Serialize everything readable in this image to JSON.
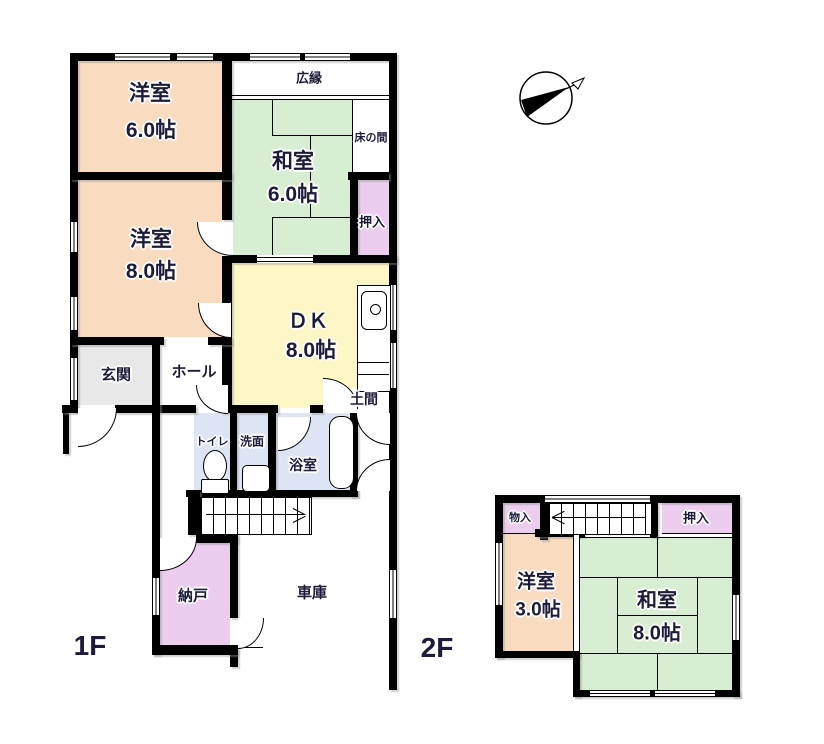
{
  "colors": {
    "wall": "#000000",
    "text": "#1c1c3a",
    "western_room": "#f9dcc0",
    "japanese_room": "#d7eed2",
    "dk_room": "#fdf7c5",
    "closet": "#eccdef",
    "wet_room": "#dde4f4",
    "entrance": "#e8e8e8"
  },
  "f1": {
    "label": "1F",
    "yoshitsu6": {
      "name": "洋室",
      "size": "6.0帖"
    },
    "yoshitsu8": {
      "name": "洋室",
      "size": "8.0帖"
    },
    "washitsu6": {
      "name": "和室",
      "size": "6.0帖"
    },
    "hiroen": {
      "name": "広縁"
    },
    "tokonoma": {
      "name": "床の間"
    },
    "oshiire": {
      "name": "押入"
    },
    "dk": {
      "name": "ＤＫ",
      "size": "8.0帖"
    },
    "doma": {
      "name": "土間"
    },
    "genkan": {
      "name": "玄関"
    },
    "hall": {
      "name": "ホール"
    },
    "toilet": {
      "name": "トイレ"
    },
    "senmen": {
      "name": "洗面"
    },
    "yokushitsu": {
      "name": "浴室"
    },
    "nando": {
      "name": "納戸"
    },
    "shako": {
      "name": "車庫"
    }
  },
  "f2": {
    "label": "2F",
    "monoire": {
      "name": "物入"
    },
    "oshiire": {
      "name": "押入"
    },
    "yoshitsu3": {
      "name": "洋室",
      "size": "3.0帖"
    },
    "washitsu8": {
      "name": "和室",
      "size": "8.0帖"
    }
  }
}
